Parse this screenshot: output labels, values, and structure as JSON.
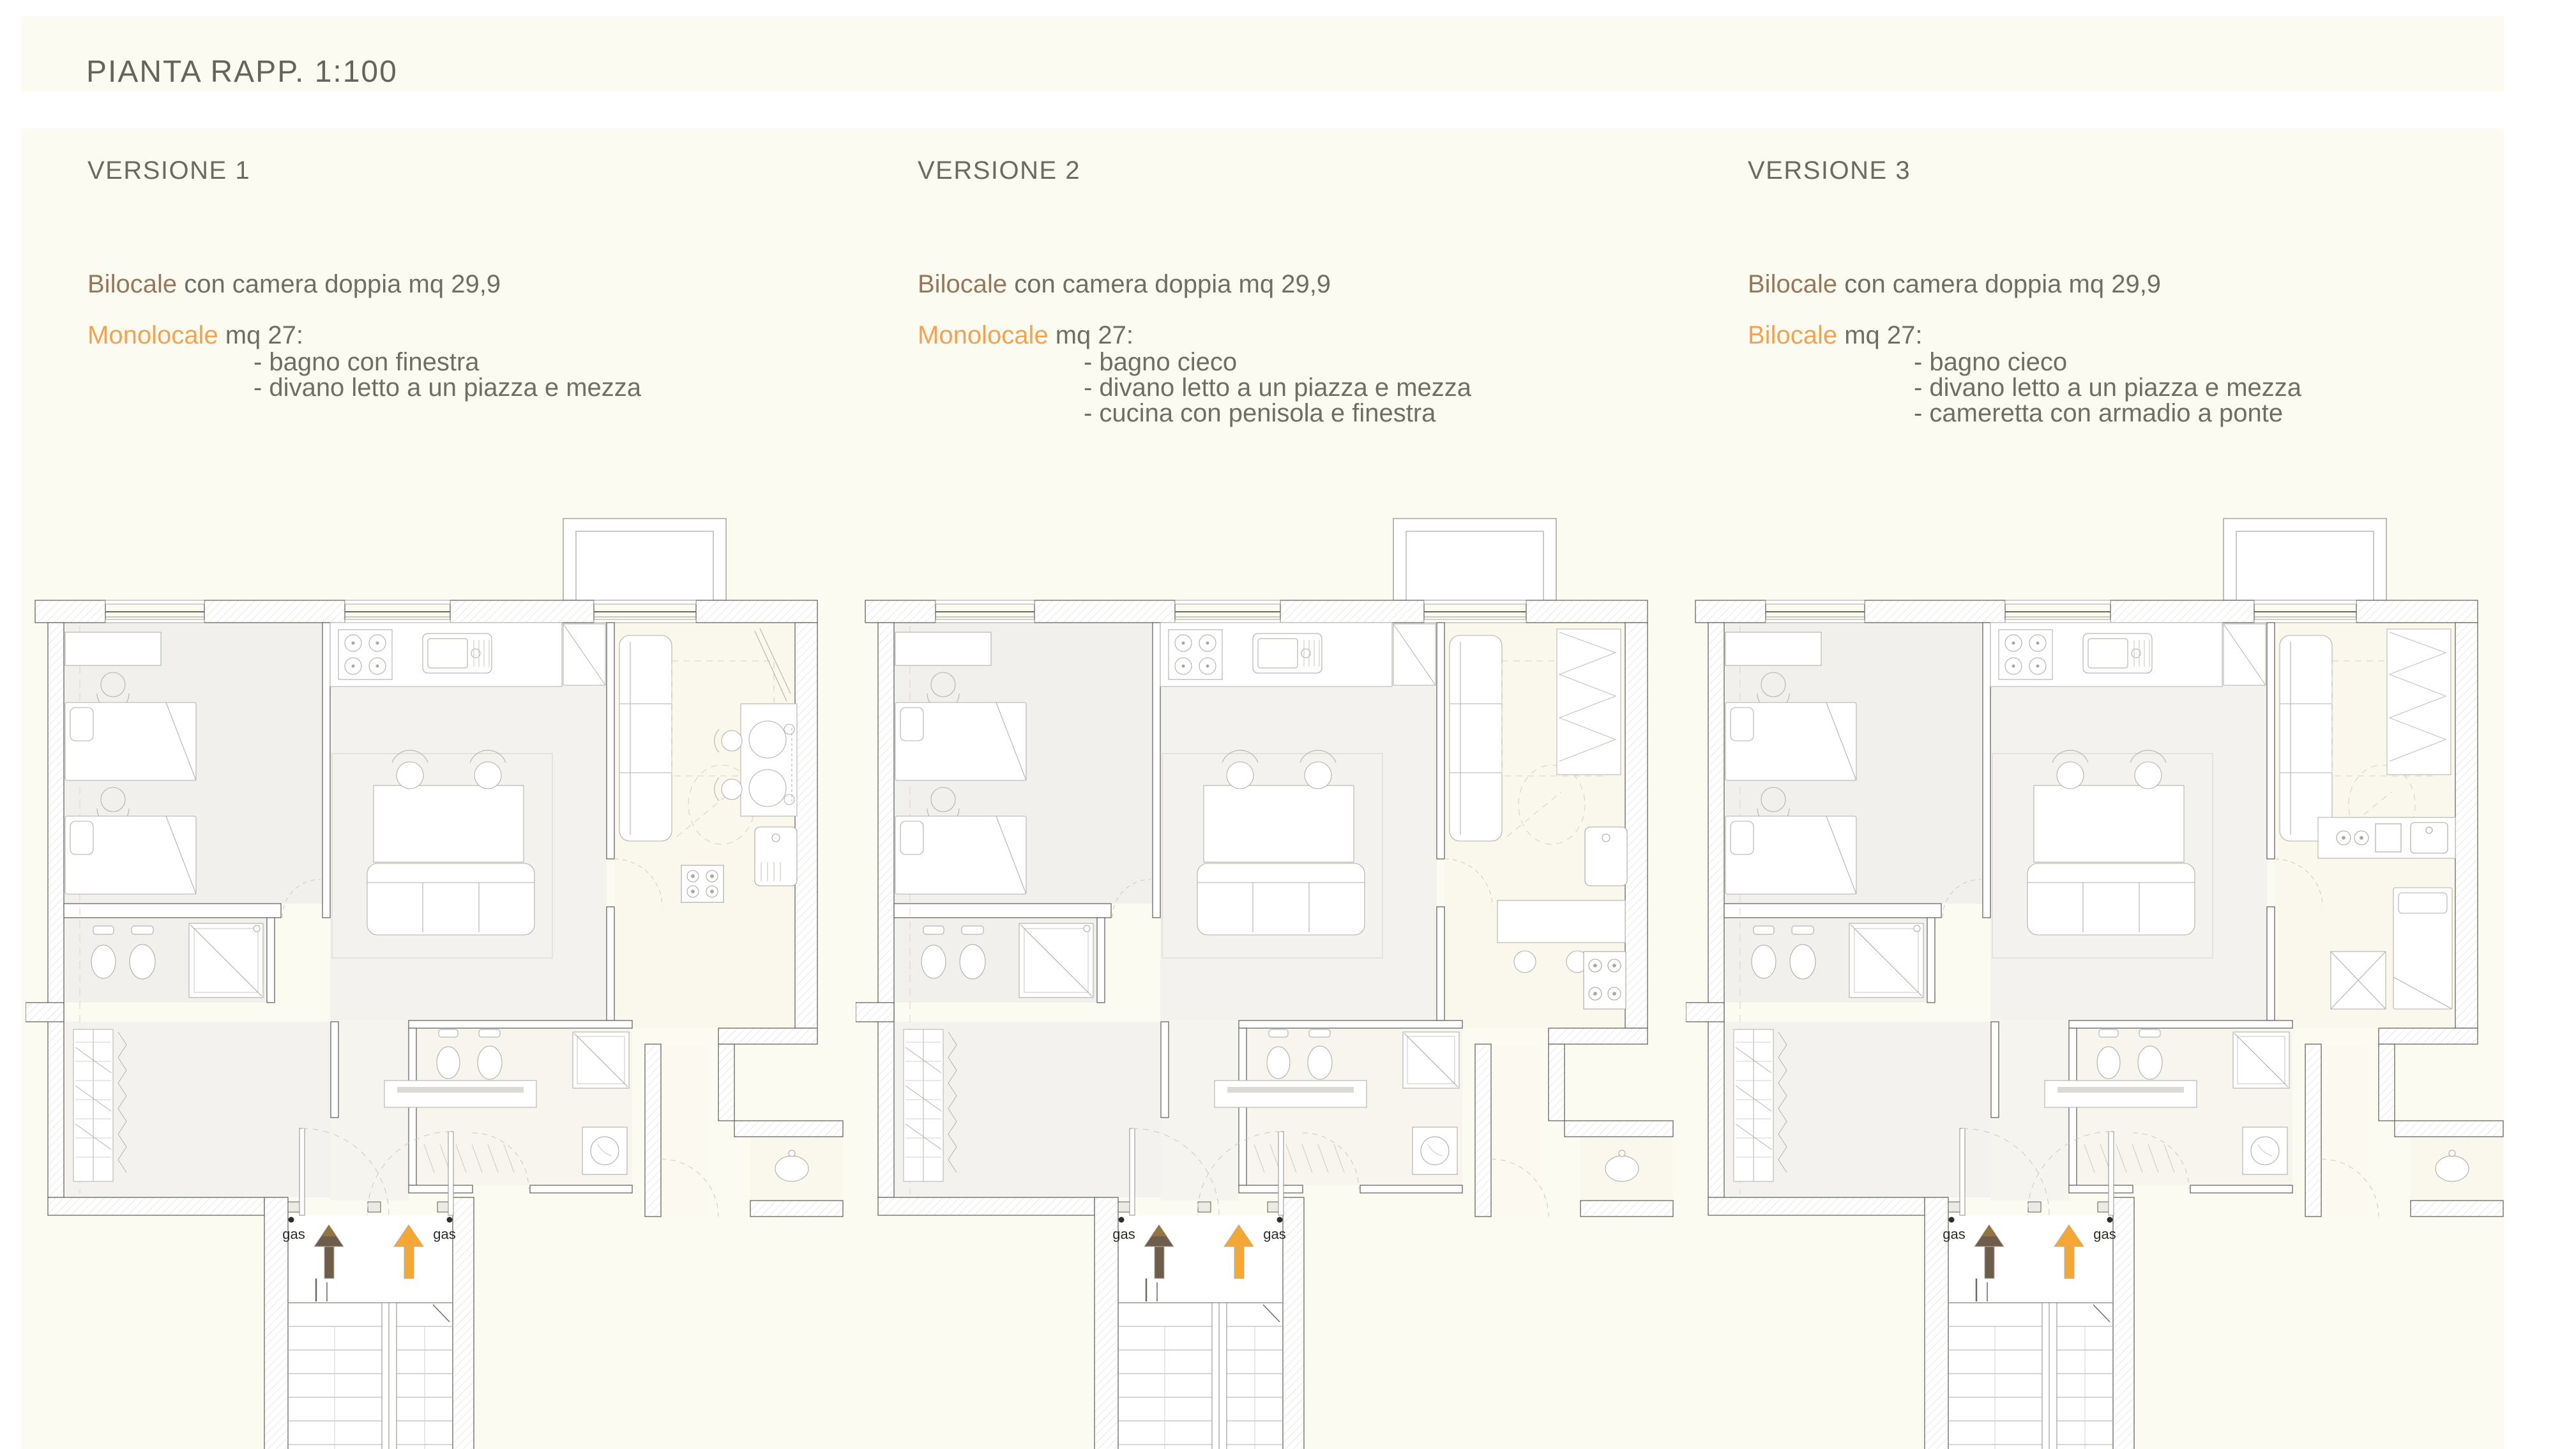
{
  "page": {
    "title": "PIANTA RAPP. 1:100"
  },
  "colors": {
    "page_background": "#fbfbf1",
    "canvas_margin": "#ffffff",
    "text_gray": "#6e6e66",
    "title_gray": "#65655d",
    "bilocale_brown": "#97775c",
    "highlight_orange": "#f1a351",
    "arrow_brown": "#6d5d4a",
    "arrow_brown_light": "#93743f",
    "arrow_orange": "#f5a733",
    "wall_stroke": "#5c5c55",
    "hatch_line": "#d8d7d1",
    "furniture_stroke": "#b4b2ab",
    "fixture_stroke": "#a9a7a0"
  },
  "versions": [
    {
      "title": "VERSIONE 1",
      "line1_lead": "Bilocale",
      "line1_rest": " con camera doppia mq 29,9",
      "line2_lead": "Monolocale",
      "line2_rest": " mq 27:",
      "bullets": [
        "- bagno con finestra",
        "- divano letto a un piazza e mezza"
      ],
      "plan_variant": "v1"
    },
    {
      "title": "VERSIONE 2",
      "line1_lead": "Bilocale",
      "line1_rest": " con camera doppia mq 29,9",
      "line2_lead": "Monolocale",
      "line2_rest": " mq 27:",
      "bullets": [
        "- bagno cieco",
        "- divano letto a un piazza e mezza",
        "- cucina con penisola e finestra"
      ],
      "plan_variant": "v2"
    },
    {
      "title": "VERSIONE 3",
      "line1_lead": "Bilocale",
      "line1_rest": " con camera doppia mq 29,9",
      "line2_lead": "Bilocale",
      "line2_rest": " mq 27:",
      "bullets": [
        "- bagno cieco",
        "- divano letto a un piazza e mezza",
        "- cameretta con armadio a ponte"
      ],
      "plan_variant": "v3"
    }
  ],
  "plan": {
    "gas_label": "gas"
  }
}
